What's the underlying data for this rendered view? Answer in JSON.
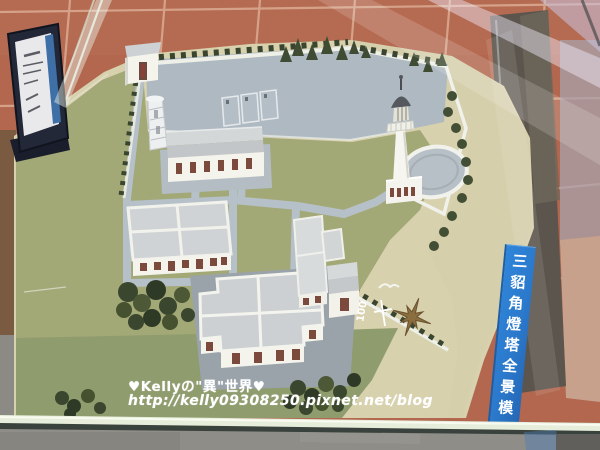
{
  "scene": {
    "sign": {
      "chars": [
        "三",
        "貂",
        "角",
        "燈",
        "塔",
        "全",
        "景",
        "模"
      ],
      "visible_title": "三貂角燈塔全景模",
      "bg_color": "#2b7cd4",
      "text_color": "#ffffff"
    },
    "watermark": {
      "line1": "♥Kellyの\"異\"世界♥",
      "line2": "http://kelly09308250.pixnet.net/blog",
      "color": "#ffffff"
    },
    "markers": {
      "scale_label": "100",
      "compass_icon": "compass-rose",
      "bird_icon": "seagull"
    },
    "palette": {
      "floor_tile": "#b2674e",
      "tile_grout": "#d9a88f",
      "sand_base": "#d8d1ae",
      "lawn": "#a3a877",
      "lawn_dark": "#8f9c6e",
      "pavement": "#aeb9c2",
      "courtyard": "#9aa3aa",
      "building_white": "#f4f3ec",
      "roof_gray": "#cfd3d5",
      "door_brown": "#7c4a3c",
      "tree_green": "#3c4831",
      "lighthouse_dome": "#55595d",
      "dark_reflection": "#655d53",
      "under_table_floor": "#8f8d88",
      "glass_edge": "#e6edda"
    }
  }
}
